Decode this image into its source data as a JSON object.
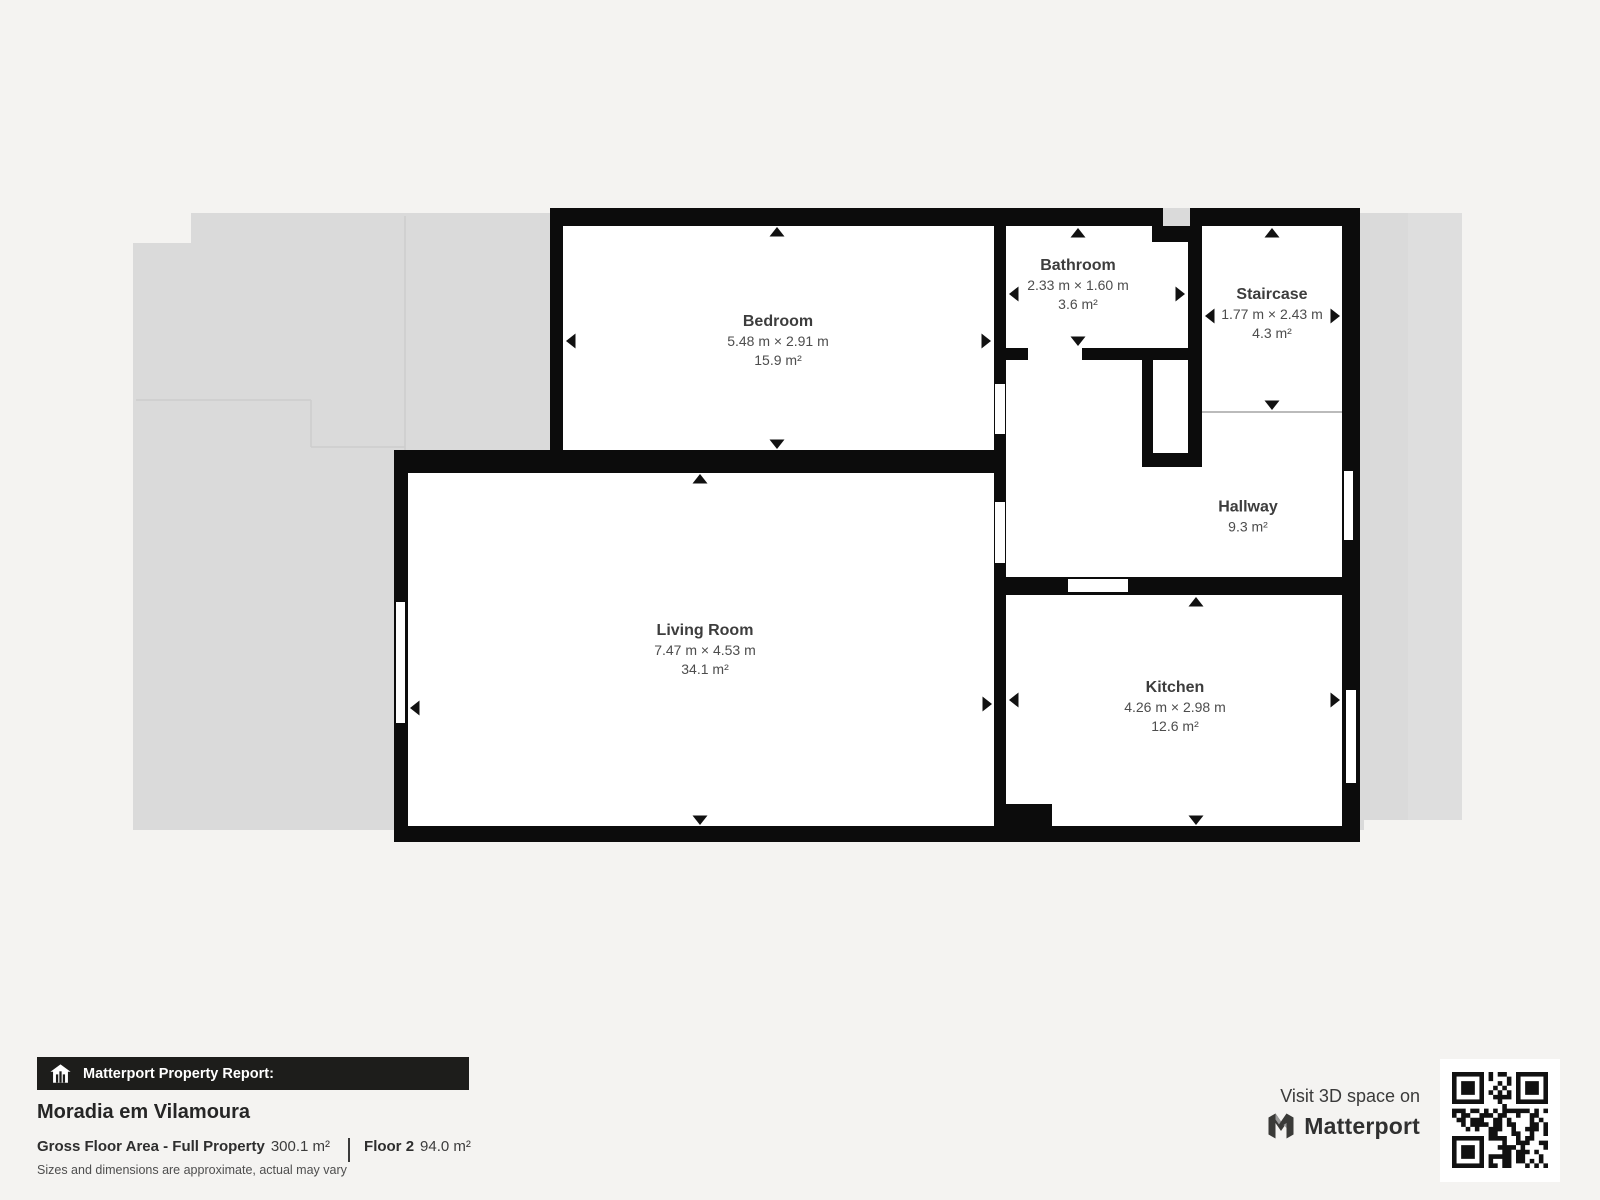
{
  "floor_plan": {
    "floor_label_context": "Floor 2",
    "rooms": [
      {
        "name": "Bedroom",
        "dims": "5.48 m × 2.91 m",
        "area": "15.9 m²"
      },
      {
        "name": "Bathroom",
        "dims": "2.33 m × 1.60 m",
        "area": "3.6 m²"
      },
      {
        "name": "Staircase",
        "dims": "1.77 m × 2.43 m",
        "area": "4.3 m²"
      },
      {
        "name": "Hallway",
        "area": "9.3 m²"
      },
      {
        "name": "Living Room",
        "dims": "7.47 m × 4.53 m",
        "area": "34.1 m²"
      },
      {
        "name": "Kitchen",
        "dims": "4.26 m × 2.98 m",
        "area": "12.6 m²"
      }
    ]
  },
  "footer": {
    "report_bar": "Matterport Property Report:",
    "property_name": "Moradia em Vilamoura",
    "gross_label": "Gross Floor Area - Full Property",
    "gross_value": "300.1 m²",
    "floor_label": "Floor 2",
    "floor_value": "94.0 m²",
    "disclaimer": "Sizes and dimensions are approximate, actual may vary"
  },
  "branding": {
    "visit_text": "Visit 3D space on",
    "brand_name": "Matterport",
    "icons": [
      "matterport-report-house-icon",
      "matterport-logo-icon",
      "qr-code"
    ]
  },
  "colors": {
    "wall": "#0c0c0c",
    "room_floor": "#ffffff",
    "lower_floor_backdrop": "#dadada",
    "page_background": "#f4f3f1",
    "report_bar_background": "#1d1d1b",
    "label_text": "#3d3d3d"
  }
}
